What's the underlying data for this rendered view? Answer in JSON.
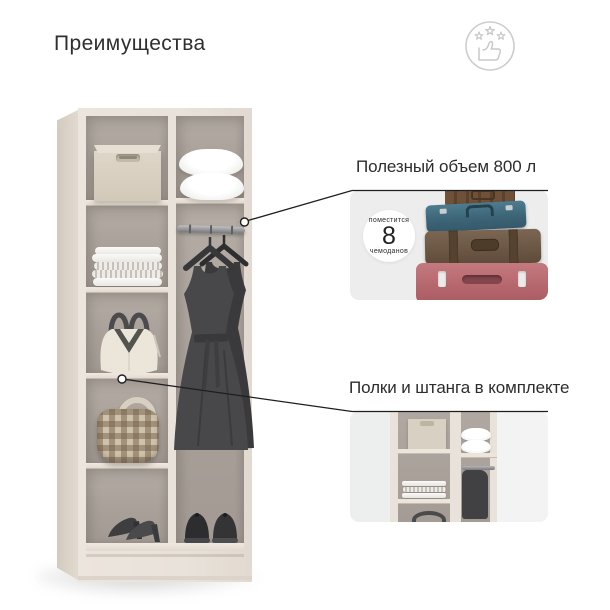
{
  "header": {
    "title": "Преимущества"
  },
  "brand": {
    "label": "РИМ",
    "icon": "thumbs-up-with-stars-icon",
    "color": "#c8c8c8"
  },
  "callouts": [
    {
      "id": "volume",
      "title": "Полезный объем 800 л",
      "badge": {
        "top": "поместится",
        "value": "8",
        "bottom": "чемоданов"
      },
      "image": "stacked-suitcases-photo",
      "image_bg": "#ededed",
      "suitcase_colors": {
        "trunk": "#6e5138",
        "teal": "#3c6577",
        "leather": "#6b5644",
        "pink": "#b5666d"
      }
    },
    {
      "id": "equipment",
      "title": "Полки и штанга в комплекте",
      "image": "wardrobe-interior-crop-photo",
      "image_bg": "#edefee"
    }
  ],
  "wardrobe": {
    "frame_color": "#e9e2da",
    "interior_color": "#a8a099",
    "contents": [
      "storage-box",
      "pillows",
      "folded-linens",
      "hanging-rod",
      "dresses-on-hangers",
      "white-handbag",
      "checkered-handbag",
      "womens-heels",
      "mens-shoes"
    ]
  },
  "connector": {
    "color": "#1e1e1e"
  }
}
